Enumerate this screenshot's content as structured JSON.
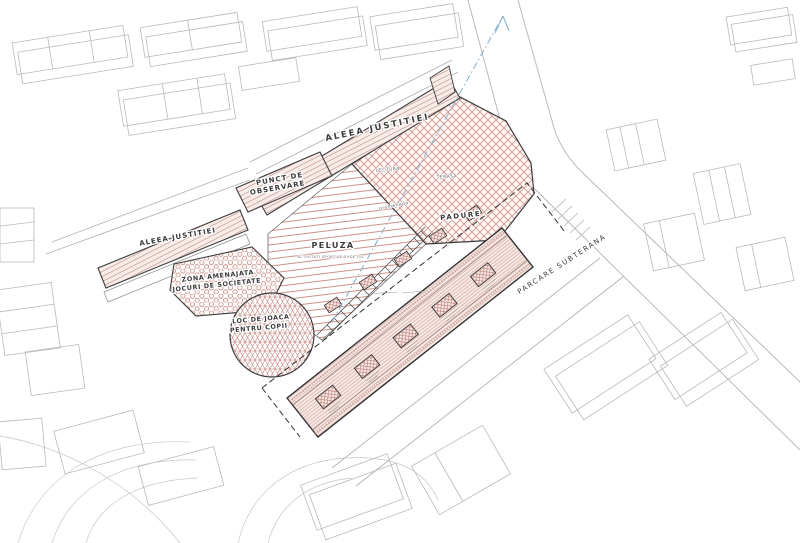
{
  "drawing": {
    "kind": "axonometric landscape site plan",
    "labels": {
      "aleea_top": "ALEEA JUSTITIEI",
      "aleea_left": "ALEEA JUSTITIEI",
      "punct_l1": "PUNCT DE",
      "punct_l2": "OBSERVARE",
      "zona_l1": "ZONA AMENAJATA",
      "zona_l2": "JOCURI DE SOCIETATE",
      "loc_l1": "LOC DE JOACA",
      "loc_l2": "PENTRU COPII",
      "peluza": "PELUZA",
      "peluza_sub": "ACTIVITATI SPORTIVE SI DE JOC",
      "padure": "PADURE",
      "lectura": "LECTURA",
      "terasa": "TERASA",
      "promenada": "promenada",
      "parcare": "PARCARE SUBTERANA"
    },
    "colors": {
      "hatch_red": "#c4857c",
      "outline": "#3d3d3d",
      "context_gray": "#b9b9b9",
      "arrow_blue": "#8bb4cf"
    }
  }
}
